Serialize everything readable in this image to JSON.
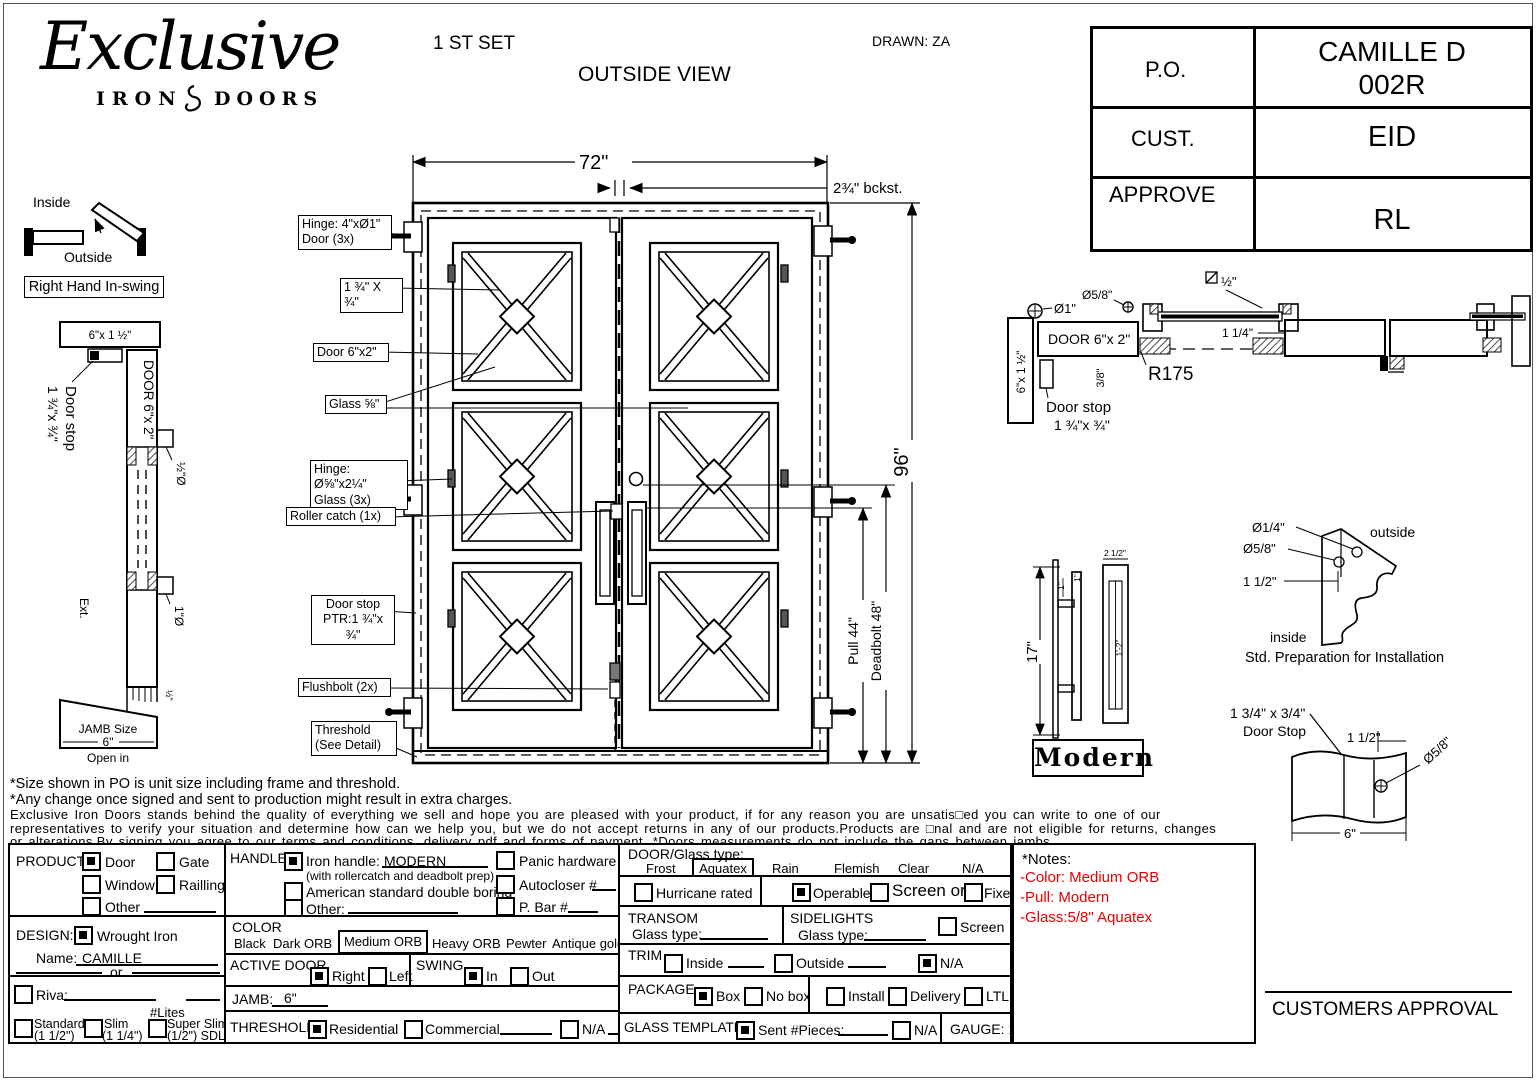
{
  "colors": {
    "accent_red": "#e80000",
    "line_black": "#000000"
  },
  "header": {
    "set_label": "1 ST SET",
    "view_label": "OUTSIDE VIEW",
    "drawn_label": "DRAWN: ZA",
    "logo": {
      "script": "Exclusive",
      "left": "IRON",
      "right": "DOORS"
    },
    "po_table": [
      {
        "label": "P.O.",
        "value_line1": "CAMILLE D",
        "value_line2": "002R"
      },
      {
        "label": "CUST.",
        "value_line1": "EID",
        "value_line2": ""
      },
      {
        "label": "APPROVE",
        "value_line1": "RL",
        "value_line2": ""
      }
    ]
  },
  "swing": {
    "inside": "Inside",
    "outside": "Outside",
    "handing": "Right Hand In-swing"
  },
  "jamb_section": {
    "top_size": "6\"x 1 ½\"",
    "door_stop": "Door stop",
    "door_stop_size": "1 ¾\"x ¾\"",
    "door_size": "DOOR 6\"x 2\"",
    "dia_half": "½\"Ø",
    "dia_one": "1\"Ø",
    "ext": "Ext.",
    "half_small": "½\"",
    "jamb_size_line1": "JAMB Size",
    "jamb_size_value": "6\"",
    "open_in": "Open in"
  },
  "door": {
    "width_dim": "72\"",
    "height_dim": "96\"",
    "backset_dim": "2¾\" bckst.",
    "pull_dim": "Pull 44\"",
    "deadbolt_dim": "Deadbolt 48\"",
    "callouts": {
      "hinge_door_1": "Hinge: 4\"xØ1\"",
      "hinge_door_2": "Door (3x)",
      "bar_size": "1 ¾\" X ¾\"",
      "door_size": "Door 6\"x2\"",
      "glass": "Glass ⅝\"",
      "hinge_glass_1": "Hinge: Ø⅝\"x2¼\"",
      "hinge_glass_2": "Glass (3x)",
      "roller": "Roller catch  (1x)",
      "stop_1": "Door stop",
      "stop_2": "PTR:1 ¾\"x ¾\"",
      "flushbolt": "Flushbolt (2x)",
      "threshold_1": "Threshold",
      "threshold_2": "(See Detail)"
    }
  },
  "head_section": {
    "dia_one": "Ø1\"",
    "dia_58": "Ø5/8\"",
    "door_size": "DOOR 6\"x 2\"",
    "jamb_size": "6\"x 1 ½\"",
    "offset_38": "3/8\"",
    "half": "½\"",
    "one_quarter": "1 1/4\"",
    "radius": "R175",
    "stop_1": "Door stop",
    "stop_2": "1 ¾\"x ¾\""
  },
  "handle": {
    "height": "17\"",
    "width": "2 1/2\"",
    "len": "1'-2\"",
    "one_a": "1\"",
    "one_b": "1\"",
    "name": "Modern"
  },
  "install": {
    "dia_14": "Ø1/4\"",
    "dia_58": "Ø5/8\"",
    "offset": "1 1/2\"",
    "outside": "outside",
    "inside": "inside",
    "caption": "Std. Preparation for Installation"
  },
  "stop_detail": {
    "size_1": "1 3/4\" x 3/4\"",
    "size_2": "Door Stop",
    "offset": "1 1/2\"",
    "dia": "Ø5/8\"",
    "width": "6\""
  },
  "disclaimer": {
    "line1": "*Size shown in PO is unit size including frame and threshold.",
    "line2": "*Any change once signed and sent to production might result in extra charges.",
    "line3": "Exclusive Iron Doors stands behind the quality of everything we sell and hope you are pleased with your product, if for any reason you are unsatis□ed you can write to one of our",
    "line4": "representatives to verify your situation and determine how can we help you, but we do not accept returns in any of our products.Products are □nal and are not eligible for returns, changes",
    "line5": "or alterations.By signing you agree to our terms and conditions, delivery pdf and forms of payment. *Doors measurements do not include the gaps between jambs"
  },
  "form": {
    "product": {
      "label": "PRODUCT:",
      "door": "Door",
      "gate": "Gate",
      "window": "Window",
      "railing": "Railling",
      "other": "Other"
    },
    "design": {
      "label": "DESIGN:",
      "wrought": "Wrought Iron",
      "name_label": "Name:",
      "name_value": "CAMILLE",
      "or": "or",
      "riva": "Riva:",
      "lites": "#Lites",
      "standard": "Standard",
      "standard_sub": "(1 1/2\")",
      "slim": "Slim",
      "slim_sub": "(1 1/4\")",
      "super_slim": "Super Slim",
      "super_slim_sub": "(1/2\") SDL"
    },
    "handle": {
      "label": "HANDLE",
      "iron": "Iron handle:",
      "iron_value": "MODERN",
      "iron_note": "(with rollercatch and deadbolt prep)",
      "american": "American standard double boring",
      "other": "Other:",
      "panic": "Panic hardware",
      "autocloser": "Autocloser #",
      "pbar": "P. Bar #"
    },
    "color": {
      "label": "COLOR",
      "black": "Black",
      "dark": "Dark ORB",
      "medium": "Medium ORB",
      "heavy": "Heavy ORB",
      "pewter": "Pewter",
      "antique": "Antique gold"
    },
    "active_door": {
      "label": "ACTIVE DOOR",
      "right": "Right",
      "left": "Left"
    },
    "swing": {
      "label": "SWING",
      "in_": "In",
      "out": "Out"
    },
    "jamb": {
      "label": "JAMB:",
      "value": "6\""
    },
    "threshold": {
      "label": "THRESHOLD",
      "residential": "Residential",
      "commercial": "Commercial",
      "na": "N/A"
    },
    "door_glass": {
      "label": "DOOR/Glass type:",
      "frost": "Frost",
      "aquatex": "Aquatex",
      "rain": "Rain",
      "flemish": "Flemish",
      "clear": "Clear",
      "na": "N/A"
    },
    "rated": {
      "hurricane": "Hurricane rated",
      "operable": "Operable",
      "screen_or": "Screen or",
      "fixed": "Fixed"
    },
    "transom": {
      "label": "TRANSOM",
      "glass_type": "Glass type:"
    },
    "sidelights": {
      "label": "SIDELIGHTS",
      "glass_type": "Glass type:",
      "screen": "Screen"
    },
    "trim": {
      "label": "TRIM",
      "inside": "Inside",
      "outside": "Outside",
      "na": "N/A"
    },
    "package": {
      "label": "PACKAGE",
      "box": "Box",
      "no_box": "No box",
      "install": "Install",
      "delivery": "Delivery",
      "ltl": "LTL"
    },
    "glass_template": {
      "label": "GLASS TEMPLATE",
      "sent": "Sent #Pieces:",
      "na": "N/A"
    },
    "gauge": "GAUGE: 14"
  },
  "notes": {
    "title": "*Notes:",
    "color": "-Color: Medium ORB",
    "pull": "-Pull: Modern",
    "glass": "-Glass:5/8\"   Aquatex"
  },
  "approval": "CUSTOMERS APPROVAL"
}
